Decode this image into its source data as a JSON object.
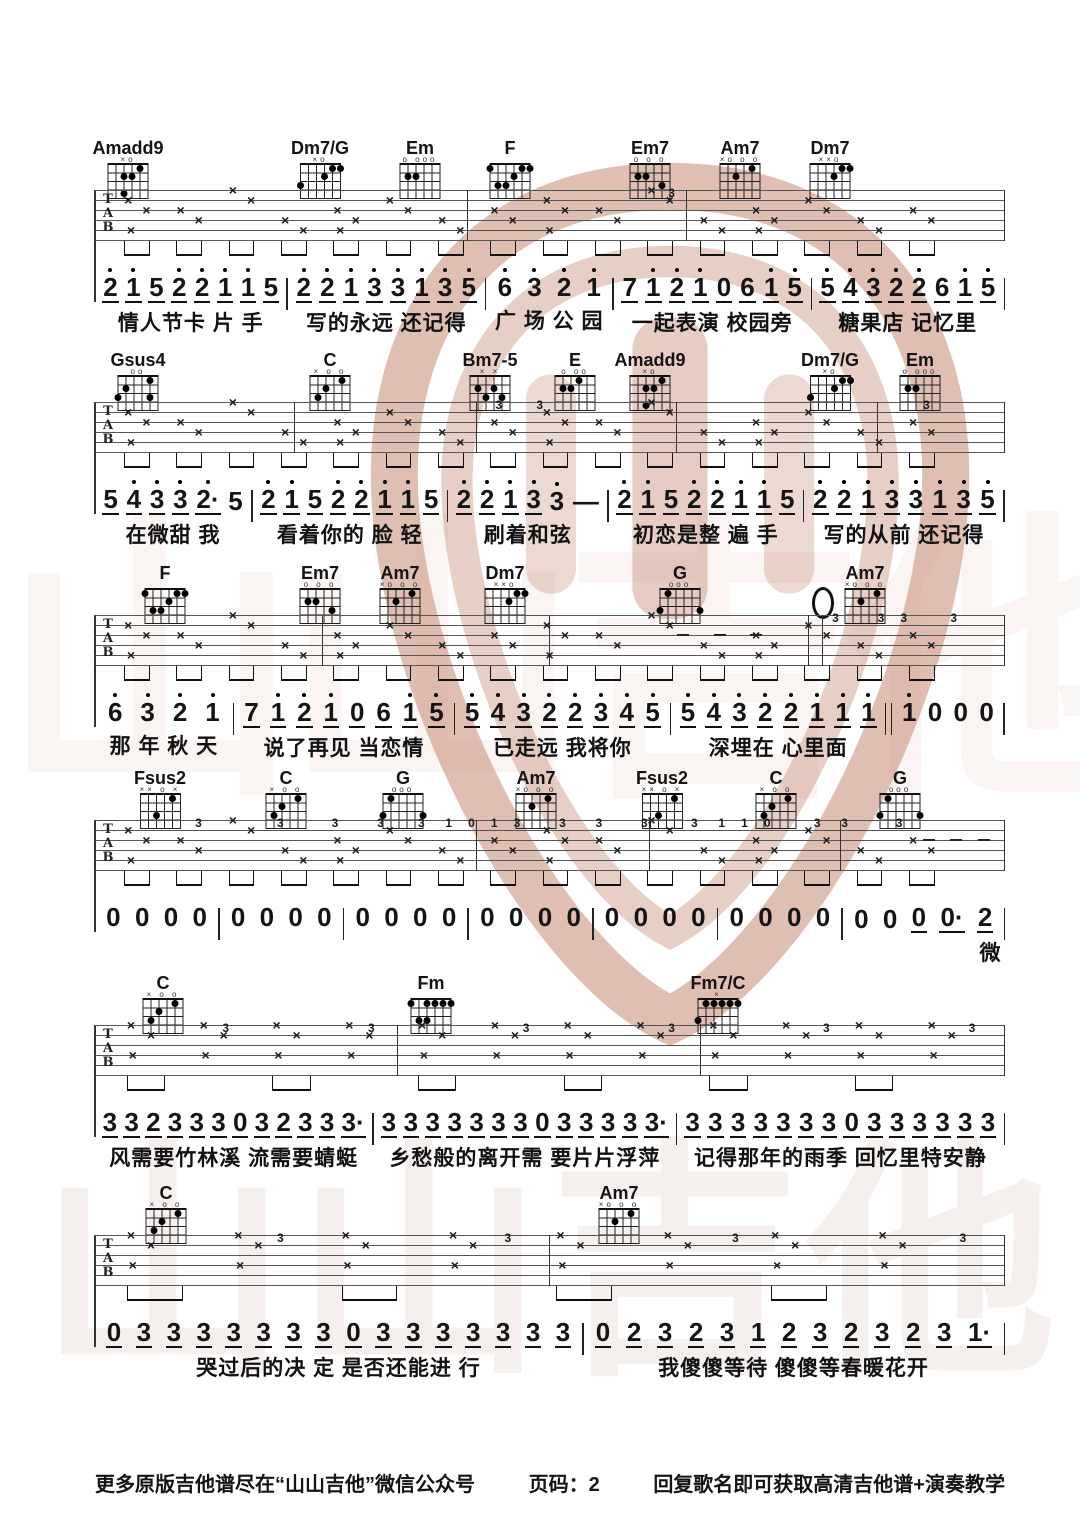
{
  "watermark": {
    "text": "山山吉他",
    "logo_color": "#c08066"
  },
  "tab_letters": [
    "T",
    "A",
    "B"
  ],
  "footer": {
    "left": "更多原版吉他谱尽在“山山吉他”微信公众号",
    "center": "页码：2",
    "right": "回复歌名即可获取高清吉他谱+演奏教学"
  },
  "systems": [
    {
      "chords": [
        {
          "name": "Amadd9",
          "x": 33,
          "marks": "×o",
          "dots": [
            [
              4,
              0
            ],
            [
              2,
              1
            ],
            [
              3,
              1
            ],
            [
              2,
              3
            ]
          ]
        },
        {
          "name": "Dm7/G",
          "x": 225,
          "marks": "×o",
          "dots": [
            [
              4,
              0
            ],
            [
              5,
              0
            ],
            [
              3,
              1
            ],
            [
              0,
              2
            ]
          ]
        },
        {
          "name": "Em",
          "x": 325,
          "marks": "o ooo",
          "dots": [
            [
              1,
              1
            ],
            [
              2,
              1
            ]
          ]
        },
        {
          "name": "F",
          "x": 415,
          "marks": "",
          "dots": [
            [
              0,
              0
            ],
            [
              4,
              0
            ],
            [
              5,
              0
            ],
            [
              3,
              1
            ],
            [
              1,
              2
            ],
            [
              2,
              2
            ]
          ]
        },
        {
          "name": "Em7",
          "x": 555,
          "marks": "o o o",
          "dots": [
            [
              1,
              1
            ],
            [
              2,
              1
            ],
            [
              4,
              2
            ]
          ]
        },
        {
          "name": "Am7",
          "x": 645,
          "marks": "×o o o",
          "dots": [
            [
              2,
              1
            ],
            [
              4,
              0
            ]
          ]
        },
        {
          "name": "Dm7",
          "x": 735,
          "marks": "××o",
          "dots": [
            [
              4,
              0
            ],
            [
              5,
              0
            ],
            [
              3,
              1
            ]
          ]
        }
      ],
      "staff": {
        "style": "dense",
        "beats": 16,
        "bars": [
          0.41,
          0.65,
          1
        ],
        "digits": [
          {
            "x": 63,
            "d": "3"
          }
        ],
        "dashes": []
      },
      "measures": [
        {
          "nums": ".2/ .1/ 5/ .2/ .2/ .1/ .1/ 5/",
          "lyric": "情人节卡 片 手"
        },
        {
          "nums": ".2/ .2/ .1/ .3/ .3/ .1/ .3/ .5/",
          "lyric": "写的永远 还记得"
        },
        {
          "nums": ".6 .3 .2 .1",
          "lyric": "广 场 公 园"
        },
        {
          "nums": "7/ .1/ .2/ .1/ 0/ 6/ .1/ .5/",
          "lyric": "一起表演 校园旁"
        },
        {
          "nums": ".5/ .4/ .3/ .2/ .2/ 6/ .1/ .5/",
          "lyric": "糖果店 记忆里"
        }
      ]
    },
    {
      "chords": [
        {
          "name": "Gsus4",
          "x": 43,
          "marks": "oo",
          "dots": [
            [
              1,
              1
            ],
            [
              4,
              0
            ],
            [
              0,
              2
            ],
            [
              4,
              2
            ]
          ]
        },
        {
          "name": "C",
          "x": 235,
          "marks": "× o o",
          "dots": [
            [
              4,
              0
            ],
            [
              2,
              1
            ],
            [
              1,
              2
            ]
          ]
        },
        {
          "name": "Bm7-5",
          "x": 395,
          "marks": "× ×",
          "dots": [
            [
              1,
              1
            ],
            [
              3,
              1
            ],
            [
              2,
              2
            ],
            [
              4,
              2
            ]
          ]
        },
        {
          "name": "E",
          "x": 480,
          "marks": "o oo",
          "dots": [
            [
              3,
              0
            ],
            [
              1,
              1
            ],
            [
              2,
              1
            ]
          ]
        },
        {
          "name": "Amadd9",
          "x": 555,
          "marks": "×o",
          "dots": [
            [
              4,
              0
            ],
            [
              2,
              1
            ],
            [
              3,
              1
            ],
            [
              2,
              3
            ]
          ]
        },
        {
          "name": "Dm7/G",
          "x": 735,
          "marks": "×o",
          "dots": [
            [
              4,
              0
            ],
            [
              5,
              0
            ],
            [
              3,
              1
            ],
            [
              0,
              2
            ]
          ]
        },
        {
          "name": "Em",
          "x": 825,
          "marks": "o ooo",
          "dots": [
            [
              1,
              1
            ],
            [
              2,
              1
            ]
          ]
        }
      ],
      "staff": {
        "style": "dense",
        "beats": 16,
        "bars": [
          0.22,
          0.42,
          0.64,
          0.86,
          1
        ],
        "digits": [
          {
            "x": 44,
            "d": "3"
          },
          {
            "x": 48.5,
            "d": "3"
          },
          {
            "x": 91,
            "d": "3"
          }
        ],
        "dashes": []
      },
      "measures": [
        {
          "nums": "5/ .4/ .3/ .3/ .2·/ 5",
          "lyric": "在微甜  我"
        },
        {
          "nums": ".2/ .1/ 5/ .2/ .2/ .1/ .1/ 5/",
          "lyric": "看着你的 脸 轻"
        },
        {
          "nums": ".2/ .2/ .1/ .3/ .3 —",
          "lyric": "刷着和弦"
        },
        {
          "nums": ".2/ .1/ 5/ .2/ .2/ .1/ .1/ 5/",
          "lyric": "初恋是整 遍 手"
        },
        {
          "nums": ".2/ .2/ .1/ .3/ .3/ .1/ .3/ .5/",
          "lyric": "写的从前 还记得"
        }
      ]
    },
    {
      "chords": [
        {
          "name": "F",
          "x": 70,
          "marks": "",
          "dots": [
            [
              0,
              0
            ],
            [
              4,
              0
            ],
            [
              5,
              0
            ],
            [
              3,
              1
            ],
            [
              1,
              2
            ],
            [
              2,
              2
            ]
          ]
        },
        {
          "name": "Em7",
          "x": 225,
          "marks": "o o o",
          "dots": [
            [
              1,
              1
            ],
            [
              2,
              1
            ],
            [
              4,
              2
            ]
          ]
        },
        {
          "name": "Am7",
          "x": 305,
          "marks": "×o o o",
          "dots": [
            [
              2,
              1
            ],
            [
              4,
              0
            ]
          ]
        },
        {
          "name": "Dm7",
          "x": 410,
          "marks": "××o",
          "dots": [
            [
              4,
              0
            ],
            [
              5,
              0
            ],
            [
              3,
              1
            ]
          ]
        },
        {
          "name": "G",
          "x": 585,
          "marks": "ooo",
          "dots": [
            [
              1,
              0
            ],
            [
              0,
              2
            ],
            [
              5,
              2
            ]
          ]
        },
        {
          "name": "0",
          "x": 728,
          "type": "oval"
        },
        {
          "name": "Am7",
          "x": 770,
          "marks": "×o o o",
          "dots": [
            [
              2,
              1
            ],
            [
              4,
              0
            ]
          ]
        }
      ],
      "staff": {
        "style": "dense",
        "beats": 16,
        "bars": [
          0.25,
          0.5,
          0.785,
          0.8,
          1
        ],
        "digits": [
          {
            "x": 81,
            "d": "3"
          },
          {
            "x": 86,
            "d": "3"
          },
          {
            "x": 88.5,
            "d": "3"
          },
          {
            "x": 94,
            "d": "3"
          }
        ],
        "dashes": [
          64,
          68,
          72
        ]
      },
      "measures": [
        {
          "nums": ".6 .3 .2 .1",
          "lyric": "那 年 秋 天"
        },
        {
          "nums": "7/ .1/ .2/ .1/ 0/ 6/ .1/ .5/",
          "lyric": "说了再见 当恋情"
        },
        {
          "nums": ".5/ .4/ .3/ .2/ .2/ .3/ .4/ .5/",
          "lyric": "已走远 我将你"
        },
        {
          "nums": ".5/ .4/ .3/ .2/ .2/ .1/ .1/ .1/",
          "lyric": "深埋在 心里面",
          "bar_after": "double"
        },
        {
          "nums": ".1 0 0 0",
          "lyric": ""
        }
      ]
    },
    {
      "chords": [
        {
          "name": "Fsus2",
          "x": 65,
          "marks": "×× o ×",
          "dots": [
            [
              4,
              0
            ],
            [
              2,
              2
            ]
          ]
        },
        {
          "name": "C",
          "x": 191,
          "marks": "× o o",
          "dots": [
            [
              4,
              0
            ],
            [
              2,
              1
            ],
            [
              1,
              2
            ]
          ]
        },
        {
          "name": "G",
          "x": 308,
          "marks": "ooo",
          "dots": [
            [
              1,
              0
            ],
            [
              0,
              2
            ],
            [
              5,
              2
            ]
          ]
        },
        {
          "name": "Am7",
          "x": 441,
          "marks": "×o o o",
          "dots": [
            [
              2,
              1
            ],
            [
              4,
              0
            ]
          ]
        },
        {
          "name": "Fsus2",
          "x": 567,
          "marks": "×× o ×",
          "dots": [
            [
              4,
              0
            ],
            [
              2,
              2
            ]
          ]
        },
        {
          "name": "C",
          "x": 681,
          "marks": "× o o",
          "dots": [
            [
              4,
              0
            ],
            [
              2,
              1
            ],
            [
              1,
              2
            ]
          ]
        },
        {
          "name": "G",
          "x": 805,
          "marks": "ooo",
          "dots": [
            [
              1,
              0
            ],
            [
              0,
              2
            ],
            [
              5,
              2
            ]
          ]
        }
      ],
      "staff": {
        "style": "dense",
        "beats": 16,
        "bars": [
          0.42,
          0.61,
          0.82,
          1
        ],
        "digits": [
          {
            "x": 11,
            "d": "3"
          },
          {
            "x": 20,
            "d": "3"
          },
          {
            "x": 26,
            "d": "3"
          },
          {
            "x": 31,
            "d": "3"
          },
          {
            "x": 35.5,
            "d": "3"
          },
          {
            "x": 38.5,
            "d": "1"
          },
          {
            "x": 41,
            "d": "0"
          },
          {
            "x": 43.5,
            "d": "1"
          },
          {
            "x": 46,
            "d": "3"
          },
          {
            "x": 51,
            "d": "3"
          },
          {
            "x": 55,
            "d": "3"
          },
          {
            "x": 60,
            "d": "3"
          },
          {
            "x": 65.5,
            "d": "3"
          },
          {
            "x": 68.5,
            "d": "1"
          },
          {
            "x": 71,
            "d": "1"
          },
          {
            "x": 73.5,
            "d": "0"
          },
          {
            "x": 79,
            "d": "3"
          },
          {
            "x": 82,
            "d": "3"
          },
          {
            "x": 88,
            "d": "3"
          }
        ],
        "dashes": [
          91,
          94,
          97
        ]
      },
      "measures": [
        {
          "nums": "0 0 0 0",
          "lyric": ""
        },
        {
          "nums": "0 0 0 0",
          "lyric": ""
        },
        {
          "nums": "0 0 0 0",
          "lyric": ""
        },
        {
          "nums": "0 0 0 0",
          "lyric": ""
        },
        {
          "nums": "0 0 0 0",
          "lyric": ""
        },
        {
          "nums": "0 0 0 0",
          "lyric": ""
        },
        {
          "nums": "0 0 0/ 0·/ 2/",
          "lyric": "微",
          "lyric_align": "right"
        }
      ]
    },
    {
      "chords": [
        {
          "name": "C",
          "x": 68,
          "marks": "× o o",
          "dots": [
            [
              4,
              0
            ],
            [
              2,
              1
            ],
            [
              1,
              2
            ]
          ]
        },
        {
          "name": "Fm",
          "x": 336,
          "marks": "",
          "dots": [
            [
              0,
              0
            ],
            [
              2,
              0
            ],
            [
              3,
              0
            ],
            [
              4,
              0
            ],
            [
              5,
              0
            ],
            [
              1,
              2
            ],
            [
              2,
              2
            ]
          ]
        },
        {
          "name": "Fm7/C",
          "x": 623,
          "marks": "×",
          "dots": [
            [
              1,
              0
            ],
            [
              2,
              0
            ],
            [
              3,
              0
            ],
            [
              4,
              0
            ],
            [
              5,
              0
            ],
            [
              0,
              2
            ]
          ]
        }
      ],
      "staff": {
        "style": "sparse12",
        "beats": 12,
        "bars": [
          0.333,
          0.666,
          1
        ],
        "digits": [
          {
            "x": 14,
            "d": "3"
          },
          {
            "x": 30,
            "d": "3"
          },
          {
            "x": 47,
            "d": "3"
          },
          {
            "x": 63,
            "d": "3"
          },
          {
            "x": 80,
            "d": "3"
          },
          {
            "x": 96,
            "d": "3"
          }
        ],
        "dashes": []
      },
      "measures": [
        {
          "nums": "3/ 3/ 2/ 3/ 3/ 3/ 0/ 3/ 2/ 3/ 3/ 3·/",
          "lyric": "风需要竹林溪 流需要蜻蜓"
        },
        {
          "nums": "3/ 3/ 3/ 3/ 3/ 3/ 3/ 0/ 3/ 3/ 3/ 3/ 3·/",
          "lyric": "乡愁般的离开需 要片片浮萍"
        },
        {
          "nums": "3/ 3/ 3/ 3/ 3/ 3/ 3/ 0/ 3/ 3/ 3/ 3/ 3/ 3/",
          "lyric": "记得那年的雨季 回忆里特安静"
        }
      ]
    },
    {
      "chords": [
        {
          "name": "C",
          "x": 71,
          "marks": "× o o",
          "dots": [
            [
              4,
              0
            ],
            [
              2,
              1
            ],
            [
              1,
              2
            ]
          ]
        },
        {
          "name": "Am7",
          "x": 524,
          "marks": "×o o o",
          "dots": [
            [
              2,
              1
            ],
            [
              4,
              0
            ]
          ]
        }
      ],
      "staff": {
        "style": "sparse8",
        "beats": 8,
        "bars": [
          0.5,
          1
        ],
        "digits": [
          {
            "x": 20,
            "d": "3"
          },
          {
            "x": 45,
            "d": "3"
          },
          {
            "x": 70,
            "d": "3"
          },
          {
            "x": 95,
            "d": "3"
          }
        ],
        "dashes": []
      },
      "measures": [
        {
          "nums": "0/ 3/ 3/ 3/ 3/ 3/ 3/ 3/ 0/ 3/ 3/ 3/ 3/ 3/ 3/ 3/",
          "lyric": "哭过后的决 定  是否还能进 行"
        },
        {
          "nums": "0/ 2/ 3/ 2/ 3/ 1/ 2/ 3/ 2/ 3/ 2/ 3/ 1·/",
          "lyric": "我傻傻等待  傻傻等春暖花开"
        }
      ]
    }
  ]
}
